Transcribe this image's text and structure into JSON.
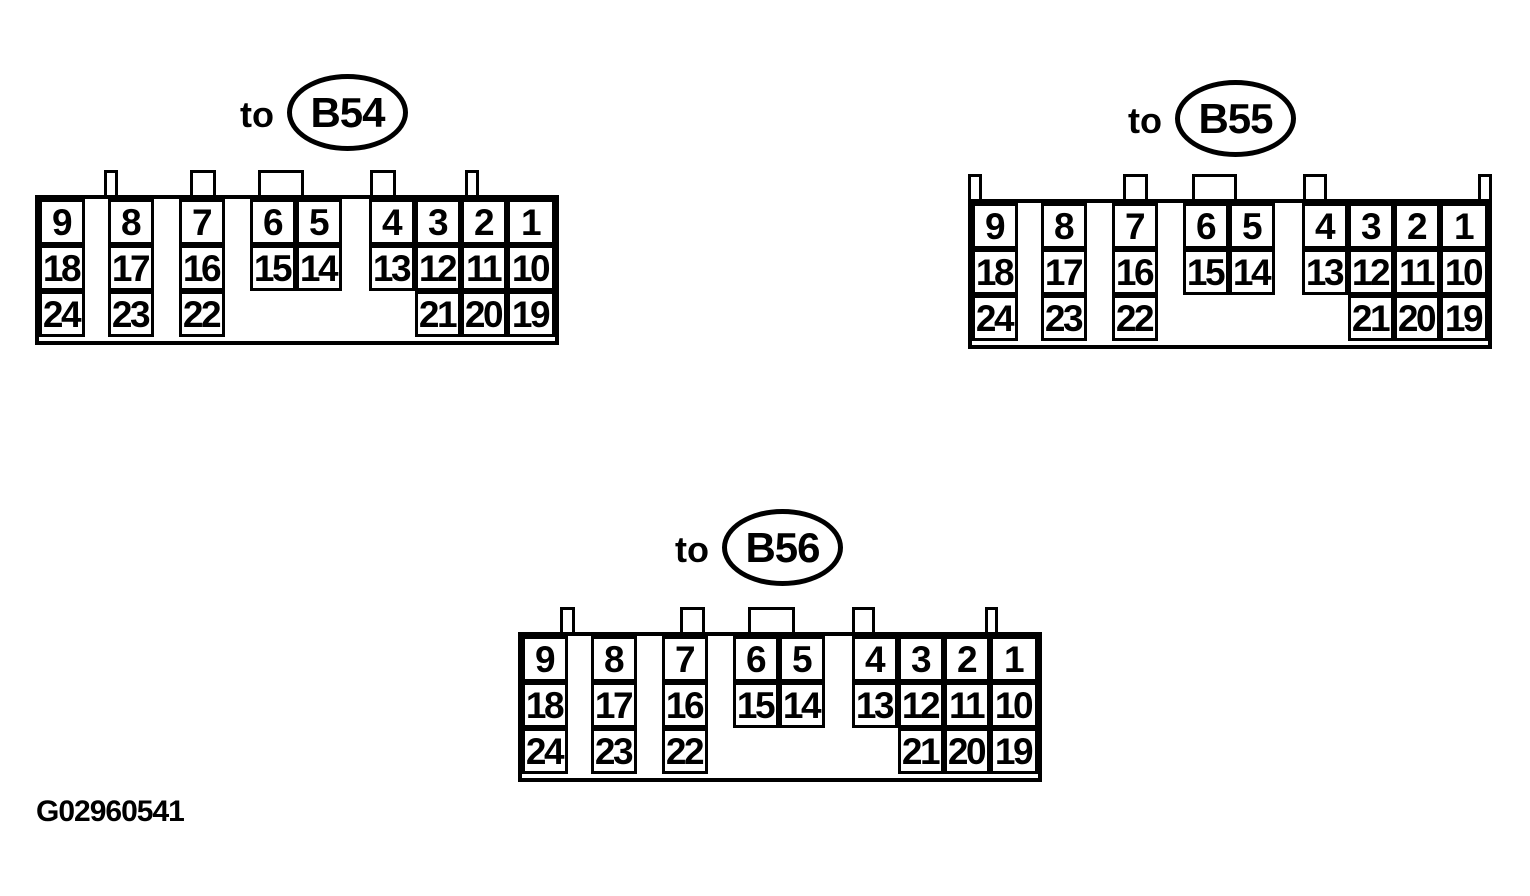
{
  "figure_id": "G02960541",
  "colors": {
    "ink": "#000000",
    "paper": "#ffffff"
  },
  "pin_rows": [
    [
      "9",
      "8",
      "7",
      "6",
      "5",
      "4",
      "3",
      "2",
      "1"
    ],
    [
      "18",
      "17",
      "16",
      "15",
      "14",
      "13",
      "12",
      "11",
      "10"
    ],
    [
      "24",
      "23",
      "22",
      null,
      null,
      null,
      "21",
      "20",
      "19"
    ]
  ],
  "connectors": [
    {
      "id": "B54",
      "label_prefix": "to",
      "tabs": [
        {
          "x": 69,
          "w": 14
        },
        {
          "x": 155,
          "w": 26
        },
        {
          "x": 223,
          "w": 46
        },
        {
          "x": 335,
          "w": 26
        },
        {
          "x": 430,
          "w": 14
        }
      ]
    },
    {
      "id": "B55",
      "label_prefix": "to",
      "tabs": [
        {
          "x": 0,
          "w": 14
        },
        {
          "x": 155,
          "w": 25
        },
        {
          "x": 224,
          "w": 45
        },
        {
          "x": 335,
          "w": 24
        },
        {
          "x": 510,
          "w": 14
        }
      ]
    },
    {
      "id": "B56",
      "label_prefix": "to",
      "tabs": [
        {
          "x": 42,
          "w": 15
        },
        {
          "x": 162,
          "w": 25
        },
        {
          "x": 230,
          "w": 47
        },
        {
          "x": 334,
          "w": 23
        },
        {
          "x": 467,
          "w": 13
        }
      ]
    }
  ]
}
